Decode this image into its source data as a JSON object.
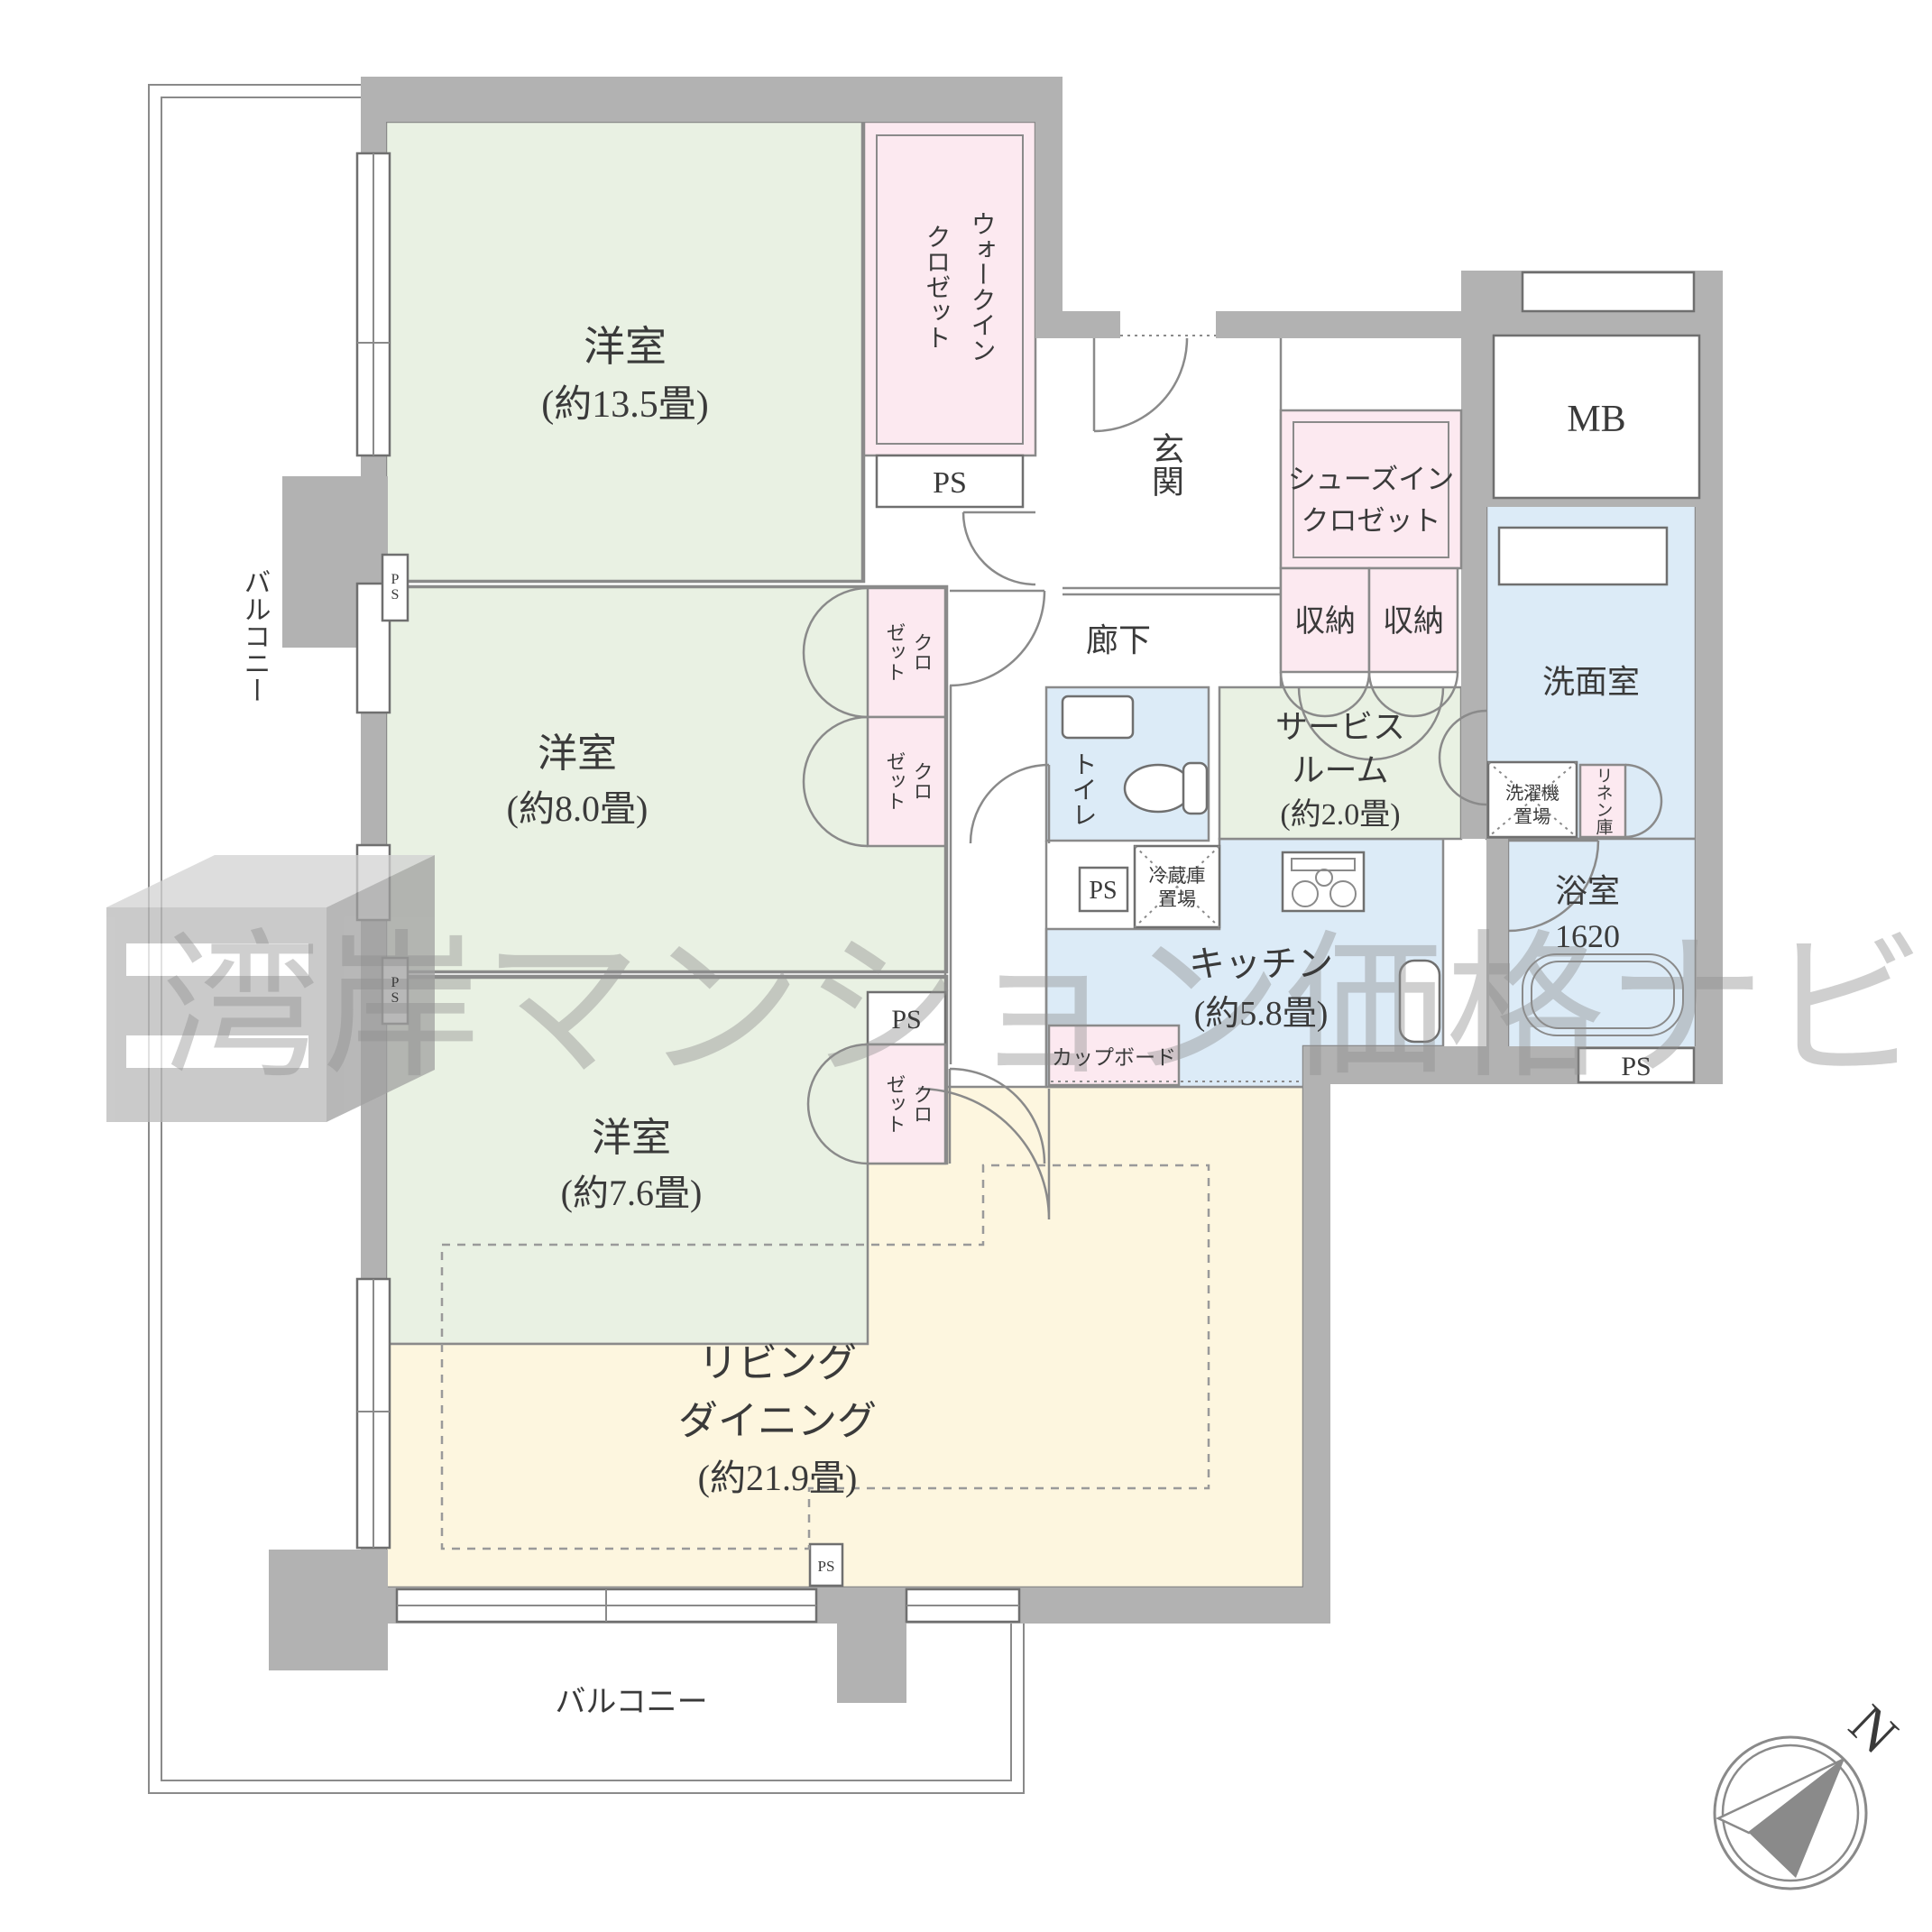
{
  "rooms": {
    "western_13": {
      "name": "洋室",
      "size": "(約13.5畳)"
    },
    "wic": {
      "col_right": "ウォークイン",
      "col_left": "クロゼット"
    },
    "western_8": {
      "name": "洋室",
      "size": "(約8.0畳)"
    },
    "closet_upper": {
      "col_right": "クロ",
      "col_left": "ゼット"
    },
    "closet_lower": {
      "col_right": "クロ",
      "col_left": "ゼット"
    },
    "western_7": {
      "name": "洋室",
      "size": "(約7.6畳)"
    },
    "closet_76": {
      "col_right": "クロ",
      "col_left": "ゼット"
    },
    "living": {
      "line1": "リビング",
      "line2": "ダイニング",
      "size": "(約21.9畳)"
    },
    "kitchen": {
      "name": "キッチン",
      "size": "(約5.8畳)"
    },
    "cupboard": "カップボード",
    "service": {
      "line1": "サービス",
      "line2": "ルーム",
      "size": "(約2.0畳)"
    },
    "toilet": "トイレ",
    "entrance": "玄関",
    "hallway": "廊下",
    "sic": {
      "line1": "シューズイン",
      "line2": "クロゼット"
    },
    "storage_left": "収納",
    "storage_right": "収納",
    "mb": "MB",
    "washroom": "洗面室",
    "washer": {
      "line1": "洗濯機",
      "line2": "置場"
    },
    "linen": "リネン庫",
    "fridge": {
      "line1": "冷蔵庫",
      "line2": "置場"
    },
    "bath": {
      "name": "浴室",
      "size": "1620"
    },
    "balcony_left": "バルコニー",
    "balcony_bottom": "バルコニー"
  },
  "ps": {
    "wic": "PS",
    "wall_upper": "PS",
    "wall_lower": "PS",
    "room76": "PS",
    "kitchen": "PS",
    "bath": "PS",
    "living": "PS"
  },
  "watermark": "湾岸マンション価格ナビ",
  "compass": {
    "n": "N"
  }
}
